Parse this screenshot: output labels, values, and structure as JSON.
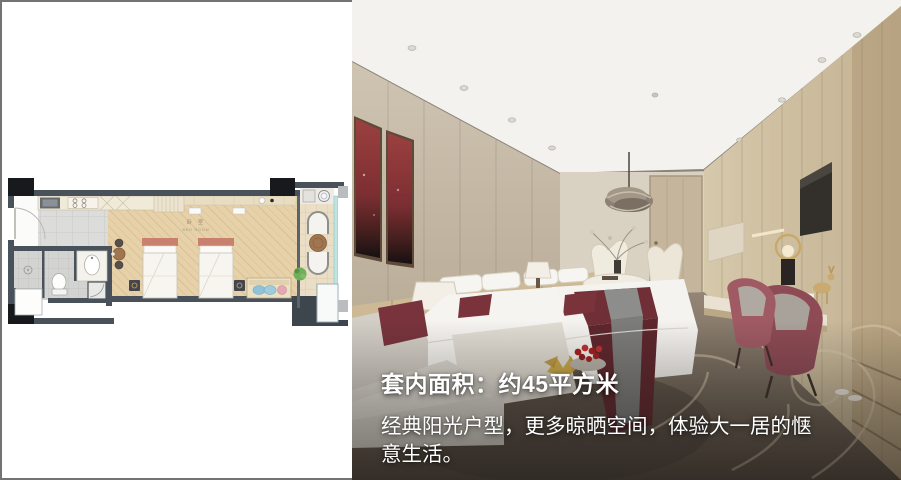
{
  "canvas": {
    "width": 901,
    "height": 480,
    "background": "#ffffff",
    "border_color": "#737373"
  },
  "caption": {
    "title": "套内面积：约45平方米",
    "description": "经典阳光户型，更多晾晒空间，体验大一居的惬意生活。",
    "text_color": "#ffffff"
  },
  "floor_plan": {
    "room_label_cn": "卧 室",
    "room_label_en": "BED ROOM",
    "colors": {
      "wall": "#49525a",
      "column": "#17191c",
      "wood_floor": "#e6d1a9",
      "tile_floor": "#d8d8d6",
      "balcony_floor": "#eadfc6",
      "bed_headboard": "#c9806e",
      "window_glass": "#bfe4e2",
      "plant": "#6fae5a",
      "sofa_cushion_blue": "#8fc3d9",
      "sofa_cushion_pink": "#e3a8b4",
      "table_wood": "#a0754f"
    }
  },
  "photo": {
    "colors": {
      "ceiling": "#f3f2ef",
      "wall_left": "#c9bead",
      "wall_back": "#d9d1c2",
      "wood_right": "#cfc0a3",
      "artwork_red": "#8e3636",
      "bedding_white": "#f5f3ef",
      "runner_maroon": "#6e3138",
      "runner_gray": "#8b8b89",
      "chair_maroon": "#9d5560",
      "carpet": "#8b7d6d",
      "carpet_swirl": "#d8cbad"
    }
  }
}
